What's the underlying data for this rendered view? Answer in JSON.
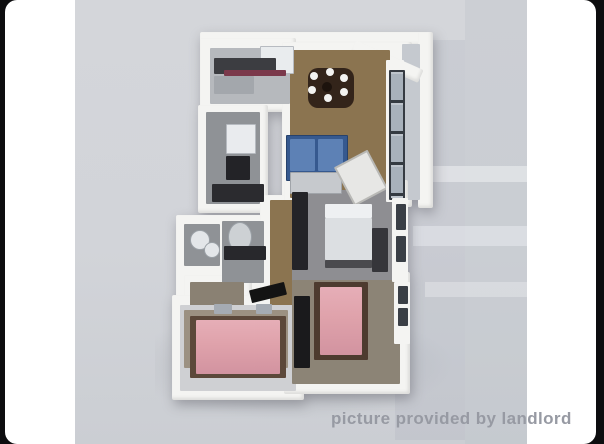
{
  "photo": {
    "watermark": "picture provided by landlord",
    "type": "3d-floorplan-render"
  },
  "floorplan": {
    "rooms": [
      "kitchen",
      "dining-area",
      "living-room",
      "bathroom",
      "bathroom-2",
      "hallway",
      "bedroom-middle",
      "bedroom-bottom-left",
      "bedroom-bottom-right",
      "balcony",
      "closet"
    ],
    "furniture": [
      "fridge",
      "kitchen-counter",
      "dining-table",
      "dinner-plates",
      "sofa",
      "coffee-table",
      "armchair",
      "sink",
      "toilet",
      "double-bed-white",
      "double-bed-pink-left",
      "double-bed-pink-right",
      "window-wall"
    ]
  },
  "colors": {
    "frame-black": "#0d0d0f",
    "page-white": "#ffffff",
    "photo-bg": "#d2d4d9",
    "wall-white": "#f4f4f2",
    "wood-floor": "#8b7450",
    "tile-gray": "#8f9296",
    "kitchen-gray": "#b6b9bd",
    "bedroom-gray": "#8e8e92",
    "carpet-light": "#cfd0d3",
    "carpet-tan": "#8c8476",
    "bed-pink": "#dfa2ab",
    "bed-frame-brown": "#54402f",
    "sofa-blue": "#36598f",
    "table-brown": "#33241a",
    "counter-dark": "#3c3d41",
    "accent-maroon": "#7b394b",
    "glass-blue": "#a8b1bb",
    "watermark-gray": "#979aa3"
  }
}
